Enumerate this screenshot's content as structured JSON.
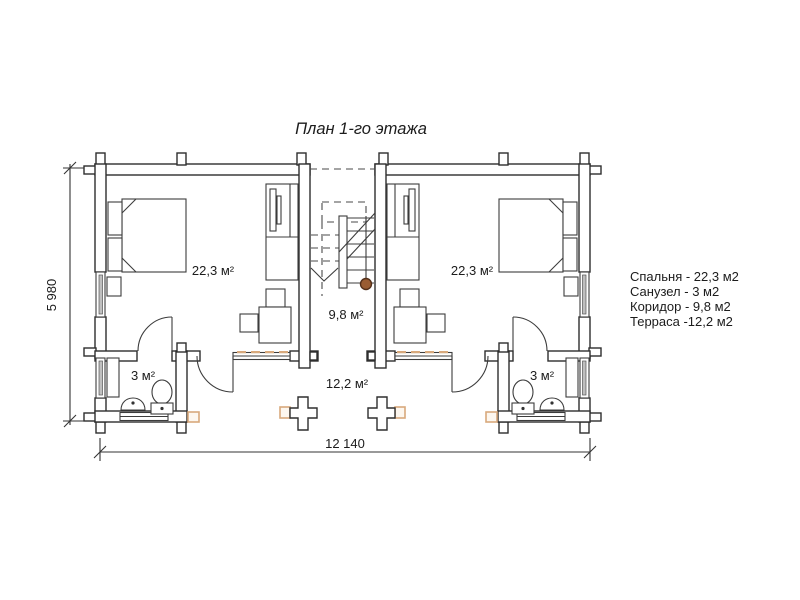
{
  "title": "План 1-го этажа",
  "rooms": {
    "bedroom_left": "22,3 м²",
    "bedroom_right": "22,3 м²",
    "corridor": "9,8 м²",
    "terrace": "12,2 м²",
    "bathroom_left": "3 м²",
    "bathroom_right": "3 м²"
  },
  "dimensions": {
    "width": "12 140",
    "height": "5 980"
  },
  "legend": {
    "items": [
      {
        "label": "Спальня - 22,3 м2"
      },
      {
        "label": "Санузел - 3 м2"
      },
      {
        "label": "Коридор - 9,8 м2"
      },
      {
        "label": "Терраса -12,2 м2"
      }
    ]
  },
  "colors": {
    "line": "#2e2e2e",
    "accent_tan": "#d8a97c",
    "newel_brown": "#9a5c32",
    "background": "#ffffff"
  }
}
